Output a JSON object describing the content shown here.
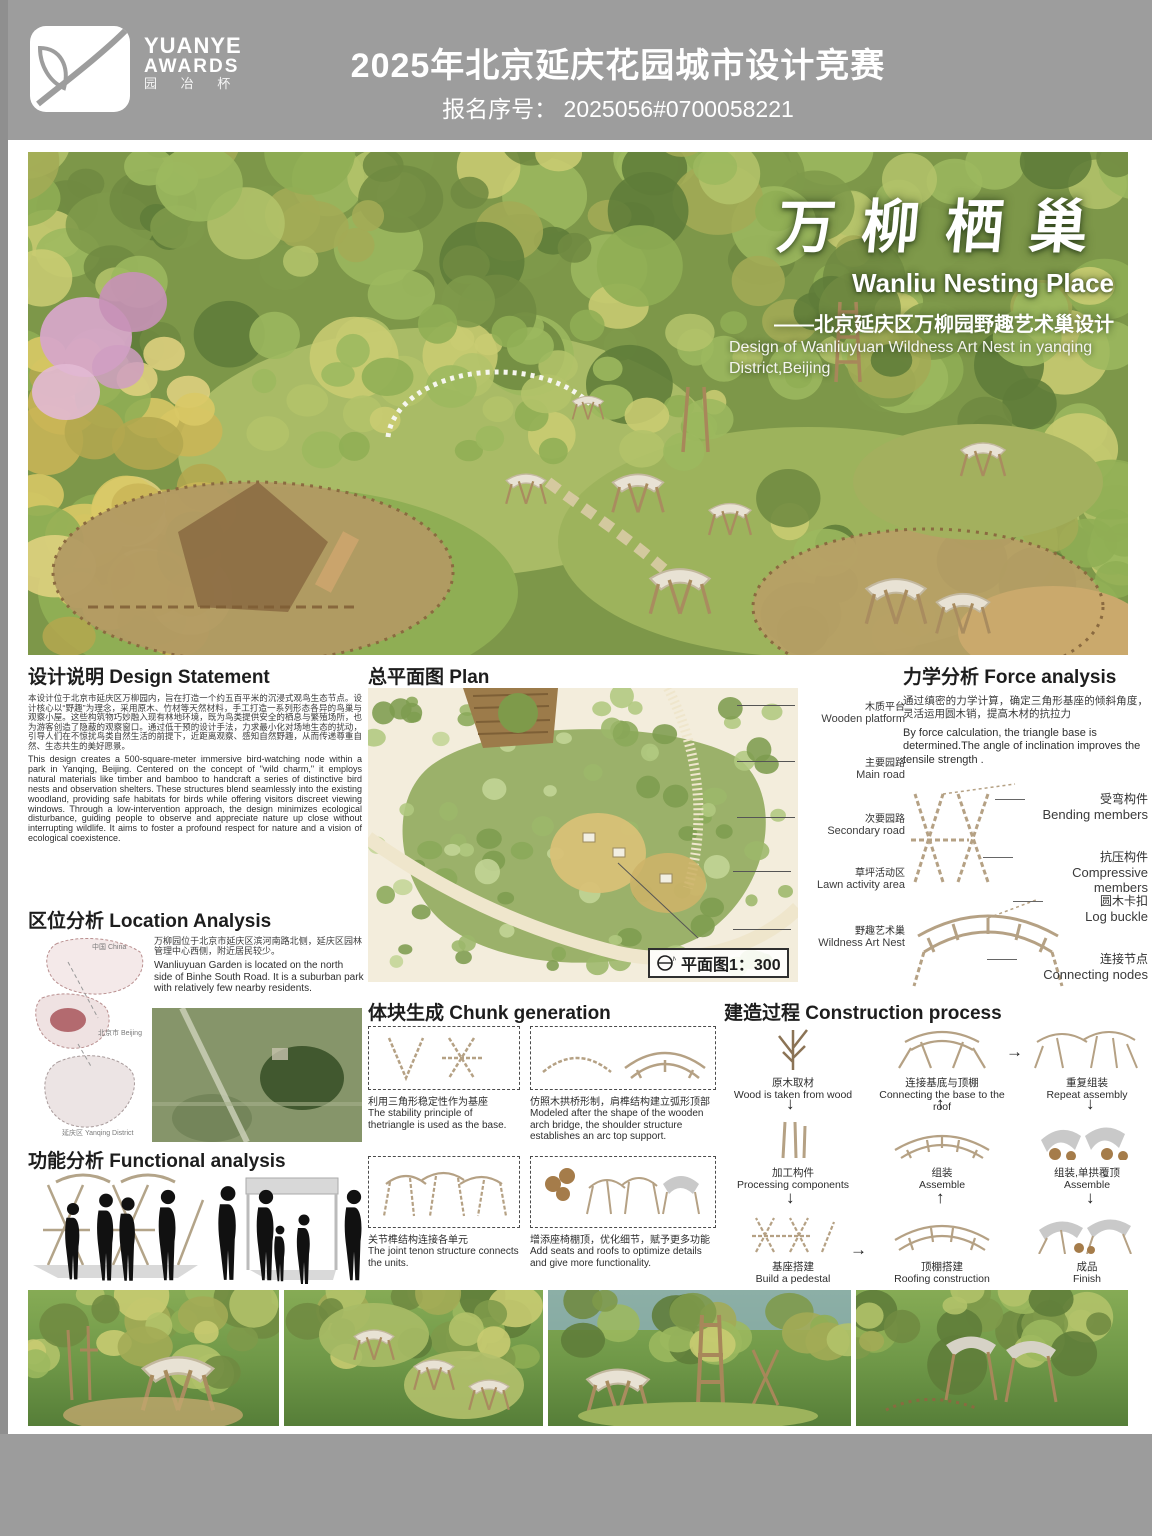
{
  "header": {
    "logo": {
      "line1": "YUANYE",
      "line2": "AWARDS",
      "line3": "园 冶 杯"
    },
    "title": "2025年北京延庆花园城市设计竞赛",
    "reg_no": "报名序号： 2025056#0700058221"
  },
  "hero": {
    "title_zh": "万柳栖巢",
    "title_en": "Wanliu Nesting Place",
    "subtitle_zh": "——北京延庆区万柳园野趣艺术巢设计",
    "subtitle_en": "Design of Wanliuyuan Wildness Art Nest in yanqing District,Beijing"
  },
  "design_statement": {
    "heading": "设计说明 Design Statement",
    "zh": "本设计位于北京市延庆区万柳园内，旨在打造一个约五百平米的沉浸式观鸟生态节点。设计核心以“野趣”为理念，采用原木、竹材等天然材料，手工打造一系列形态各异的鸟巢与观察小屋。这些构筑物巧妙融入现有林地环境，既为鸟类提供安全的栖息与繁殖场所，也为游客创造了隐蔽的观察窗口。通过低干预的设计手法，力求最小化对场地生态的扰动，引导人们在不惊扰鸟类自然生活的前提下，近距离观察、感知自然野趣，从而传递尊重自然、生态共生的美好愿景。",
    "en": "This design creates a 500-square-meter immersive bird-watching node within a park in Yanqing, Beijing. Centered on the concept of \"wild charm,\" it employs natural materials like timber and bamboo to handcraft a series of distinctive bird nests and observation shelters. These structures blend seamlessly into the existing woodland, providing safe habitats for birds while offering visitors discreet viewing windows. Through a low-intervention approach, the design minimizes ecological disturbance, guiding people to observe and appreciate nature up close without interrupting wildlife. It aims to foster a profound respect for nature and a vision of ecological coexistence."
  },
  "location": {
    "heading": "区位分析 Location Analysis",
    "zh": "万柳园位于北京市延庆区滨河南路北侧，延庆区园林管理中心西侧，附近居民较少。",
    "en": "Wanliuyuan Garden is located on the north side of Binhe South Road. It is a suburban park with relatively few nearby residents.",
    "map_labels": [
      "中国 China",
      "北京市 Beijing",
      "延庆区 Yanqing District"
    ]
  },
  "plan": {
    "heading": "总平面图 Plan",
    "labels": [
      {
        "zh": "木质平台",
        "en": "Wooden platform"
      },
      {
        "zh": "主要园路",
        "en": "Main road"
      },
      {
        "zh": "次要园路",
        "en": "Secondary road"
      },
      {
        "zh": "草坪活动区",
        "en": "Lawn activity area"
      },
      {
        "zh": "野趣艺术巢",
        "en": "Wildness Art Nest"
      }
    ],
    "scale": "平面图1：300"
  },
  "force": {
    "heading": "力学分析 Force analysis",
    "zh": "通过缜密的力学计算，确定三角形基座的倾斜角度，灵活运用圆木销，提高木材的抗拉力",
    "en": "By force calculation, the triangle base is determined.The angle of inclination improves the tensile strength .",
    "labels": [
      {
        "zh": "受弯构件",
        "en": "Bending members"
      },
      {
        "zh": "抗压构件",
        "en": "Compressive members"
      },
      {
        "zh": "圆木卡扣",
        "en": "Log buckle"
      },
      {
        "zh": "连接节点",
        "en": "Connecting nodes"
      }
    ]
  },
  "chunk": {
    "heading": "体块生成 Chunk generation",
    "steps": [
      {
        "zh": "利用三角形稳定性作为基座",
        "en": "The stability principle of thetriangle is used as the base."
      },
      {
        "zh": "仿照木拱桥形制，肩榫结构建立弧形顶部",
        "en": "Modeled after the shape of the wooden arch bridge, the shoulder structure establishes an arc top support."
      },
      {
        "zh": "关节榫结构连接各单元",
        "en": "The joint tenon structure connects the units."
      },
      {
        "zh": "增添座椅棚顶，优化细节，赋予更多功能",
        "en": "Add seats and roofs to optimize details and give more functionality."
      }
    ]
  },
  "construction": {
    "heading": "建造过程 Construction process",
    "steps": [
      {
        "zh": "原木取材",
        "en": "Wood is taken from wood"
      },
      {
        "zh": "加工构件",
        "en": "Processing components"
      },
      {
        "zh": "基座搭建",
        "en": "Build a pedestal"
      },
      {
        "zh": "连接基底与顶棚",
        "en": "Connecting the base to the roof"
      },
      {
        "zh": "组装",
        "en": "Assemble"
      },
      {
        "zh": "顶棚搭建",
        "en": "Roofing construction"
      },
      {
        "zh": "重复组装",
        "en": "Repeat assembly"
      },
      {
        "zh": "组装,单拱覆顶",
        "en": "Assemble"
      },
      {
        "zh": "成品",
        "en": "Finish"
      }
    ]
  },
  "functional": {
    "heading": "功能分析 Functional analysis"
  }
}
